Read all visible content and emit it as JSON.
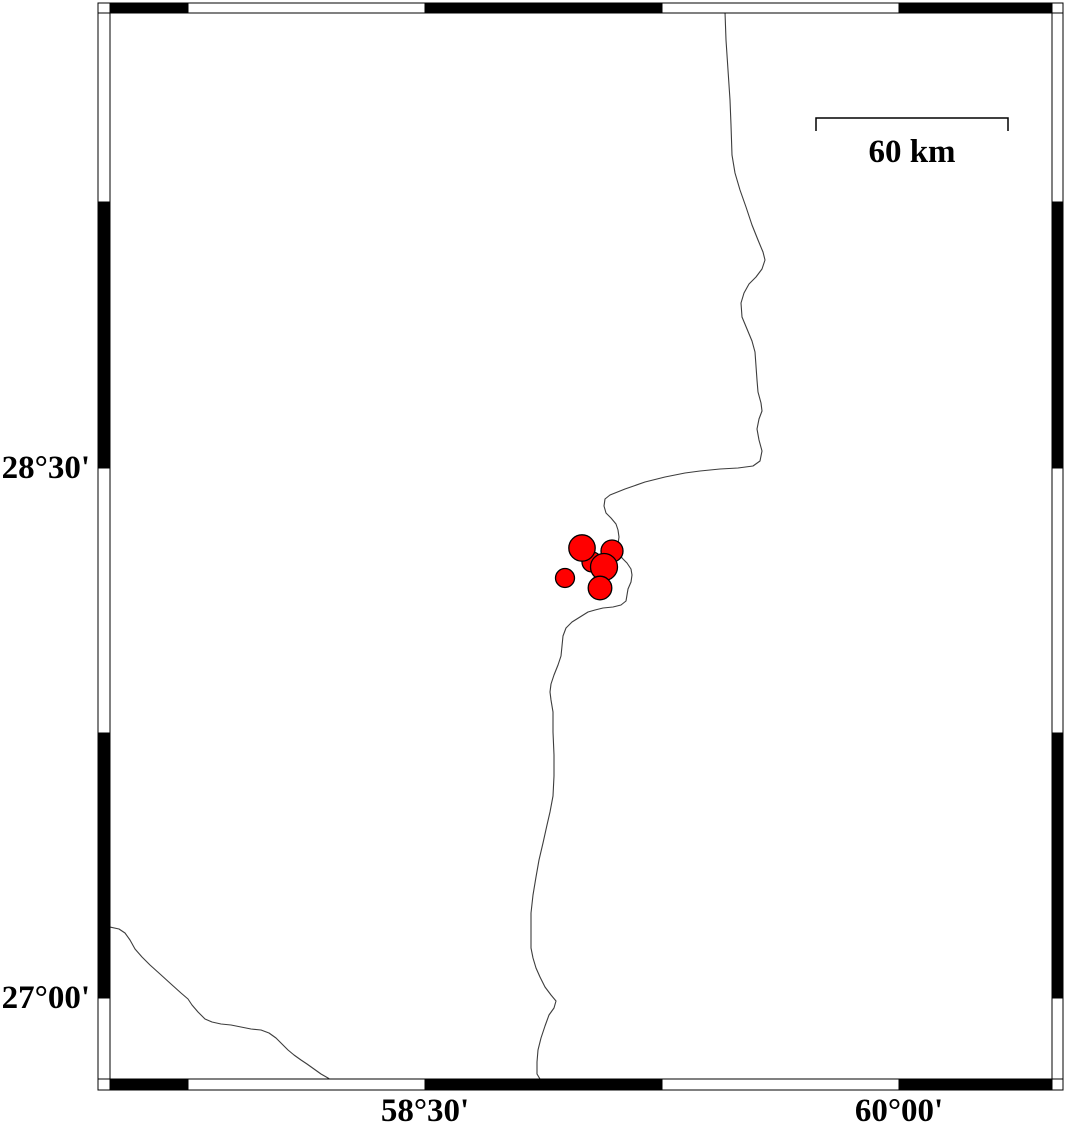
{
  "map": {
    "width": 1066,
    "height": 1127,
    "background": "#ffffff",
    "frame": {
      "outer": {
        "x": 98,
        "y": 3,
        "width": 965,
        "height": 1087
      },
      "inner": {
        "x": 110,
        "y": 13,
        "width": 942,
        "height": 1066
      },
      "on_color": "#000000",
      "off_color": "#ffffff",
      "line_color": "#000000",
      "h_boundaries": [
        110,
        188,
        425,
        662,
        899,
        1052
      ],
      "h_first_fill": "on",
      "top_bar": {
        "y": 3,
        "h": 10
      },
      "bottom_bar": {
        "y": 1079,
        "h": 11
      },
      "v_boundaries": [
        3,
        202,
        468,
        733,
        998,
        1090
      ],
      "v_first_fill": "off",
      "left_bar": {
        "x": 98,
        "w": 12
      },
      "right_bar": {
        "x": 1052,
        "w": 11
      },
      "corner_separator_ys": [
        13,
        1079
      ]
    },
    "axis_labels": {
      "left": [
        {
          "text": "28°30'",
          "x": 90,
          "y": 468
        },
        {
          "text": "27°00'",
          "x": 90,
          "y": 998
        }
      ],
      "bottom": [
        {
          "text": "58°30'",
          "x": 425,
          "y": 1111
        },
        {
          "text": "60°00'",
          "x": 899,
          "y": 1111
        }
      ]
    },
    "scale_bar": {
      "label": "60 km",
      "x1": 816,
      "x2": 1008,
      "y": 118,
      "tick_drop": 13,
      "label_x": 912,
      "label_y": 152,
      "color": "#000000"
    },
    "coast_color": "#3d3d3d",
    "coastlines": [
      {
        "name": "main-coastline",
        "points": [
          [
            725,
            12
          ],
          [
            726,
            40
          ],
          [
            728,
            70
          ],
          [
            730,
            100
          ],
          [
            731,
            125
          ],
          [
            732,
            155
          ],
          [
            735,
            173
          ],
          [
            740,
            190
          ],
          [
            746,
            207
          ],
          [
            752,
            225
          ],
          [
            758,
            240
          ],
          [
            763,
            252
          ],
          [
            765,
            260
          ],
          [
            762,
            269
          ],
          [
            756,
            277
          ],
          [
            749,
            284
          ],
          [
            744,
            293
          ],
          [
            741,
            303
          ],
          [
            742,
            317
          ],
          [
            747,
            329
          ],
          [
            752,
            341
          ],
          [
            755,
            352
          ],
          [
            756,
            366
          ],
          [
            757,
            380
          ],
          [
            758,
            392
          ],
          [
            761,
            403
          ],
          [
            762,
            411
          ],
          [
            759,
            419
          ],
          [
            757,
            429
          ],
          [
            759,
            440
          ],
          [
            762,
            451
          ],
          [
            760,
            461
          ],
          [
            753,
            466
          ],
          [
            738,
            468
          ],
          [
            720,
            469
          ],
          [
            700,
            471
          ],
          [
            685,
            473
          ],
          [
            665,
            477
          ],
          [
            645,
            482
          ],
          [
            625,
            489
          ],
          [
            610,
            495
          ],
          [
            605,
            499
          ],
          [
            604,
            506
          ],
          [
            606,
            513
          ],
          [
            611,
            518
          ],
          [
            616,
            524
          ],
          [
            618,
            530
          ],
          [
            619,
            537
          ],
          [
            618,
            544
          ],
          [
            619,
            551
          ],
          [
            622,
            558
          ],
          [
            627,
            563
          ],
          [
            631,
            569
          ],
          [
            632,
            575
          ],
          [
            631,
            582
          ],
          [
            628,
            589
          ],
          [
            627,
            595
          ],
          [
            626,
            601
          ],
          [
            621,
            605
          ],
          [
            613,
            607
          ],
          [
            603,
            608
          ],
          [
            595,
            610
          ],
          [
            588,
            612
          ],
          [
            580,
            617
          ],
          [
            572,
            622
          ],
          [
            566,
            628
          ],
          [
            563,
            636
          ],
          [
            562,
            646
          ],
          [
            561,
            656
          ],
          [
            558,
            665
          ],
          [
            554,
            675
          ],
          [
            551,
            684
          ],
          [
            550,
            692
          ],
          [
            551,
            700
          ],
          [
            553,
            712
          ],
          [
            553,
            732
          ],
          [
            554,
            755
          ],
          [
            554,
            776
          ],
          [
            553,
            796
          ],
          [
            550,
            812
          ],
          [
            547,
            825
          ],
          [
            543,
            843
          ],
          [
            539,
            860
          ],
          [
            536,
            877
          ],
          [
            533,
            895
          ],
          [
            531,
            913
          ],
          [
            531,
            931
          ],
          [
            531,
            948
          ],
          [
            533,
            958
          ],
          [
            536,
            968
          ],
          [
            540,
            977
          ],
          [
            545,
            987
          ],
          [
            551,
            995
          ],
          [
            556,
            1001
          ],
          [
            554,
            1008
          ],
          [
            549,
            1015
          ],
          [
            545,
            1026
          ],
          [
            541,
            1038
          ],
          [
            538,
            1050
          ],
          [
            537,
            1062
          ],
          [
            537,
            1074
          ],
          [
            540,
            1079
          ],
          [
            546,
            1082
          ],
          [
            553,
            1084
          ],
          [
            557,
            1088
          ]
        ]
      },
      {
        "name": "southwest-coastline",
        "points": [
          [
            110,
            927
          ],
          [
            119,
            929
          ],
          [
            125,
            933
          ],
          [
            130,
            940
          ],
          [
            135,
            949
          ],
          [
            142,
            957
          ],
          [
            150,
            965
          ],
          [
            160,
            974
          ],
          [
            171,
            984
          ],
          [
            181,
            993
          ],
          [
            188,
            999
          ],
          [
            192,
            1005
          ],
          [
            198,
            1012
          ],
          [
            205,
            1019
          ],
          [
            212,
            1022
          ],
          [
            221,
            1024
          ],
          [
            231,
            1025
          ],
          [
            241,
            1027
          ],
          [
            251,
            1029
          ],
          [
            261,
            1030
          ],
          [
            269,
            1033
          ],
          [
            276,
            1038
          ],
          [
            282,
            1044
          ],
          [
            288,
            1050
          ],
          [
            294,
            1055
          ],
          [
            301,
            1060
          ],
          [
            307,
            1064
          ],
          [
            314,
            1069
          ],
          [
            321,
            1074
          ],
          [
            328,
            1078
          ],
          [
            332,
            1081
          ]
        ]
      }
    ],
    "epicenters": {
      "fill": "#ff0000",
      "stroke": "#000000",
      "points": [
        {
          "x": 592,
          "y": 562,
          "r": 10
        },
        {
          "x": 612,
          "y": 551,
          "r": 11
        },
        {
          "x": 582,
          "y": 548,
          "r": 13.2
        },
        {
          "x": 604,
          "y": 567,
          "r": 13.5
        },
        {
          "x": 600,
          "y": 588,
          "r": 11.8
        },
        {
          "x": 565,
          "y": 578,
          "r": 9.5
        }
      ]
    }
  }
}
